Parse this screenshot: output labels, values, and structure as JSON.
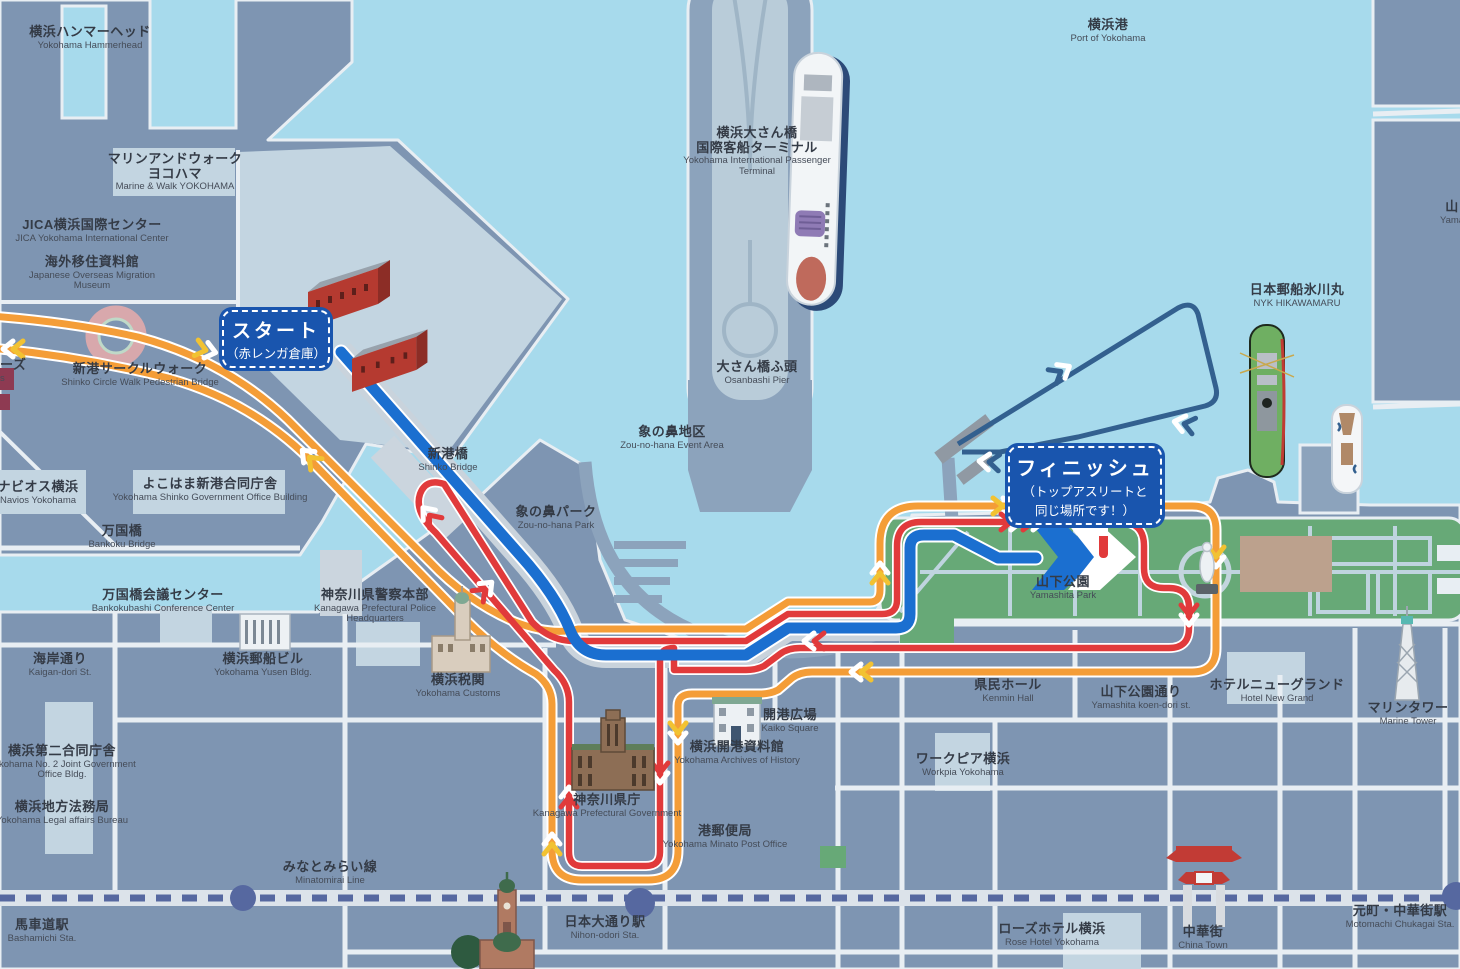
{
  "map": {
    "title": "Yokohama waterfront course map",
    "colors": {
      "water": "#A7DAEC",
      "land": "#7E95B2",
      "land_light": "#C3D5E1",
      "pier": "#8CA3BC",
      "road": "#E8EEF3",
      "road_wide": "#C9D3DC",
      "park_green": "#67A977",
      "route_orange": "#F49D37",
      "route_red": "#E13A3B",
      "route_blue": "#1B6FD0",
      "swim_loop_navy": "#33608F",
      "railway": "#5668A0",
      "badge_blue": "#1955AE",
      "brick_red": "#B53A30"
    },
    "badges": {
      "start": {
        "title": "スタート",
        "subtitle": "（赤レンガ倉庫）"
      },
      "finish": {
        "title": "フィニッシュ",
        "subtitle_line1": "（トップアスリートと",
        "subtitle_line2": "同じ場所です！）"
      }
    },
    "labels": [
      {
        "id": "hammerhead",
        "ja": "横浜ハンマーヘッド",
        "en": "Yokohama Hammerhead",
        "x": 90,
        "y": 25
      },
      {
        "id": "marine-walk",
        "ja": "マリンアンドウォーク",
        "ja2": "ヨコハマ",
        "en": "Marine & Walk YOKOHAMA",
        "x": 175,
        "y": 152
      },
      {
        "id": "jica-center",
        "ja": "JICA横浜国際センター",
        "en": "JICA Yokohama International Center",
        "x": 92,
        "y": 218,
        "w": 200
      },
      {
        "id": "migration-museum",
        "ja": "海外移住資料館",
        "en": "Japanese Overseas Migration Museum",
        "x": 92,
        "y": 255,
        "w": 140
      },
      {
        "id": "port-of-yokohama",
        "ja": "横浜港",
        "en": "Port of Yokohama",
        "x": 1108,
        "y": 18
      },
      {
        "id": "passenger-terminal",
        "ja": "横浜大さん橋",
        "ja2": "国際客船ターミナル",
        "en": "Yokohama International Passenger Terminal",
        "x": 757,
        "y": 126,
        "w": 170
      },
      {
        "id": "osanbashi-pier",
        "ja": "大さん橋ふ頭",
        "en": "Osanbashi Pier",
        "x": 757,
        "y": 360
      },
      {
        "id": "nyk-hikawamaru",
        "ja": "日本郵船氷川丸",
        "en": "NYK HIKAWAMARU",
        "x": 1297,
        "y": 283
      },
      {
        "id": "shinko-circle-walk",
        "ja": "新港サークルウォーク",
        "en": "Shinko Circle Walk Pedestrian Bridge",
        "x": 140,
        "y": 362,
        "w": 260
      },
      {
        "id": "shinko-bridge",
        "ja": "新港橋",
        "en": "Shinko Bridge",
        "x": 448,
        "y": 447
      },
      {
        "id": "zou-no-hana-event",
        "ja": "象の鼻地区",
        "en": "Zou-no-hana Event Area",
        "x": 672,
        "y": 425
      },
      {
        "id": "zou-no-hana-park",
        "ja": "象の鼻パーク",
        "en": "Zou-no-hana Park",
        "x": 556,
        "y": 505
      },
      {
        "id": "navios",
        "ja": "ナビオス横浜",
        "en": "Navios Yokohama",
        "x": 38,
        "y": 480,
        "w": 130
      },
      {
        "id": "shinko-gov-office",
        "ja": "よこはま新港合同庁舎",
        "en": "Yokohama Shinko Government Office Building",
        "x": 210,
        "y": 477,
        "w": 210
      },
      {
        "id": "bankoku-bridge",
        "ja": "万国橋",
        "en": "Bankoku Bridge",
        "x": 122,
        "y": 524
      },
      {
        "id": "bankokubashi-conf",
        "ja": "万国橋会議センター",
        "en": "Bankokubashi Conference Center",
        "x": 163,
        "y": 588,
        "w": 150
      },
      {
        "id": "police-hq",
        "ja": "神奈川県警察本部",
        "en": "Kanagawa Prefectural Police Headquarters",
        "x": 375,
        "y": 588,
        "w": 170
      },
      {
        "id": "kaigan-dori",
        "ja": "海岸通り",
        "en": "Kaigan-dori St.",
        "x": 60,
        "y": 652
      },
      {
        "id": "yusen-bldg",
        "ja": "横浜郵船ビル",
        "en": "Yokohama Yusen Bldg.",
        "x": 263,
        "y": 652
      },
      {
        "id": "customs",
        "ja": "横浜税関",
        "en": "Yokohama Customs",
        "x": 458,
        "y": 673
      },
      {
        "id": "no2-joint-gov",
        "ja": "横浜第二合同庁舎",
        "en": "Yokohama No. 2 Joint Government Office Bldg.",
        "x": 62,
        "y": 744,
        "w": 150
      },
      {
        "id": "legal-affairs",
        "ja": "横浜地方法務局",
        "en": "Yokohama Legal affairs Bureau",
        "x": 62,
        "y": 800,
        "w": 200
      },
      {
        "id": "pref-government",
        "ja": "神奈川県庁",
        "en": "Kanagawa Prefectural Government",
        "x": 607,
        "y": 793,
        "w": 160
      },
      {
        "id": "archives",
        "ja": "横浜開港資料館",
        "en": "Yokohama Archives of History",
        "x": 737,
        "y": 740,
        "w": 150
      },
      {
        "id": "kaiko-square",
        "ja": "開港広場",
        "en": "Kaiko Square",
        "x": 790,
        "y": 708
      },
      {
        "id": "minato-post",
        "ja": "港郵便局",
        "en": "Yokohama Minato Post Office",
        "x": 725,
        "y": 824,
        "w": 140
      },
      {
        "id": "workpia",
        "ja": "ワークピア横浜",
        "en": "Workpia Yokohama",
        "x": 963,
        "y": 752
      },
      {
        "id": "kenmin-hall",
        "ja": "県民ホール",
        "en": "Kenmin Hall",
        "x": 1008,
        "y": 678
      },
      {
        "id": "yamashita-park",
        "ja": "山下公園",
        "en": "Yamashita Park",
        "x": 1063,
        "y": 575
      },
      {
        "id": "koen-dori",
        "ja": "山下公園通り",
        "en": "Yamashita koen-dori st.",
        "x": 1141,
        "y": 685
      },
      {
        "id": "hotel-new-grand",
        "ja": "ホテルニューグランド",
        "en": "Hotel New Grand",
        "x": 1277,
        "y": 678,
        "w": 180
      },
      {
        "id": "marine-tower",
        "ja": "マリンタワー",
        "en": "Marine Tower",
        "x": 1408,
        "y": 701
      },
      {
        "id": "minatomirai-line",
        "ja": "みなとみらい線",
        "en": "Minatomirai Line",
        "x": 330,
        "y": 860
      },
      {
        "id": "bashamichi-sta",
        "ja": "馬車道駅",
        "en": "Bashamichi Sta.",
        "x": 42,
        "y": 918,
        "w": 110
      },
      {
        "id": "nihon-odori-sta",
        "ja": "日本大通り駅",
        "en": "Nihon-odori Sta.",
        "x": 605,
        "y": 915
      },
      {
        "id": "rose-hotel",
        "ja": "ローズホテル横浜",
        "en": "Rose Hotel Yokohama",
        "x": 1052,
        "y": 922,
        "w": 160
      },
      {
        "id": "china-town",
        "ja": "中華街",
        "en": "China Town",
        "x": 1203,
        "y": 925
      },
      {
        "id": "motomachi-sta",
        "ja": "元町・中華街駅",
        "en": "Motomachi Chukagai Sta.",
        "x": 1400,
        "y": 904,
        "w": 120
      },
      {
        "id": "world-porters-cut",
        "ja": "ーズ",
        "en": "s",
        "x": 30,
        "y": 358,
        "w": 60,
        "align": "left"
      },
      {
        "id": "yamashita-pier-cut",
        "ja": "山",
        "en": "Yama",
        "x": 1452,
        "y": 200,
        "w": 60
      }
    ],
    "icons": [
      "red-brick-warehouse-icon",
      "cruise-ship-icon",
      "hikawamaru-ship-icon",
      "small-boat-icon",
      "circle-walk-icon",
      "customs-tower-icon",
      "yusen-building-icon",
      "archives-building-icon",
      "prefectural-government-icon",
      "memorial-hall-tower-icon",
      "marine-tower-icon",
      "chinatown-gate-icon",
      "statue-icon",
      "fountain-icon",
      "finish-flag-icon",
      "station-dot",
      "railway-line",
      "start-pontoon-icon"
    ]
  }
}
